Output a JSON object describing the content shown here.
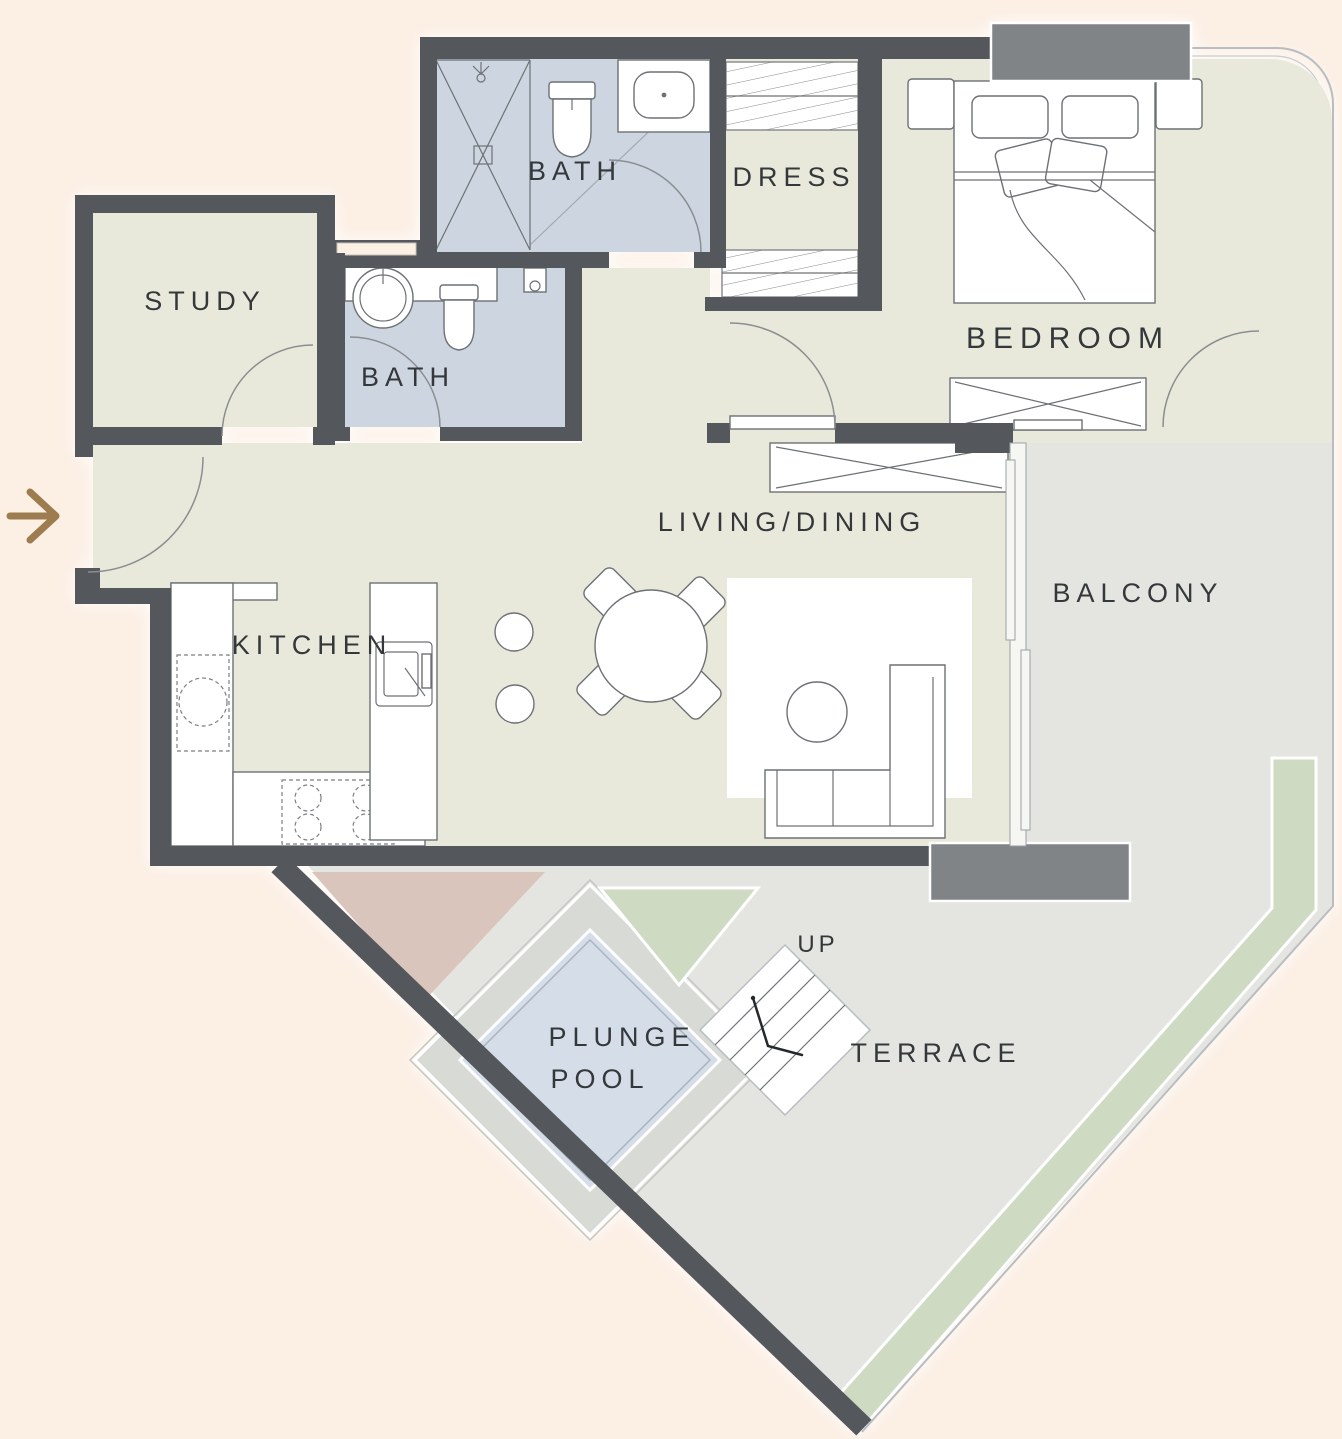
{
  "title": "apartment-floor-plan",
  "labels": {
    "study": "STUDY",
    "bath_top": "BATH",
    "bath_middle": "BATH",
    "dress": "DRESS",
    "bedroom": "BEDROOM",
    "living_dining": "LIVING/DINING",
    "kitchen": "KITCHEN",
    "balcony": "BALCONY",
    "plunge_pool_line_1": "PLUNGE",
    "plunge_pool_line_2": "POOL",
    "stairs_up": "UP",
    "terrace": "TERRACE"
  },
  "icons": {
    "entry_arrow": "entry-direction-arrow"
  },
  "colors": {
    "bg": "#fcefe4",
    "floor": "#e9e9db",
    "bath": "#cdd6e0",
    "outdoor": "#e4e5e1",
    "deck": "#d8dad5",
    "pool": "#d4dde8",
    "green": "#cfdac3",
    "rose": "#d9c5bb",
    "wall": "#54575c",
    "window": "#818487",
    "label": "#34383b",
    "arrow": "#9d7c50"
  }
}
